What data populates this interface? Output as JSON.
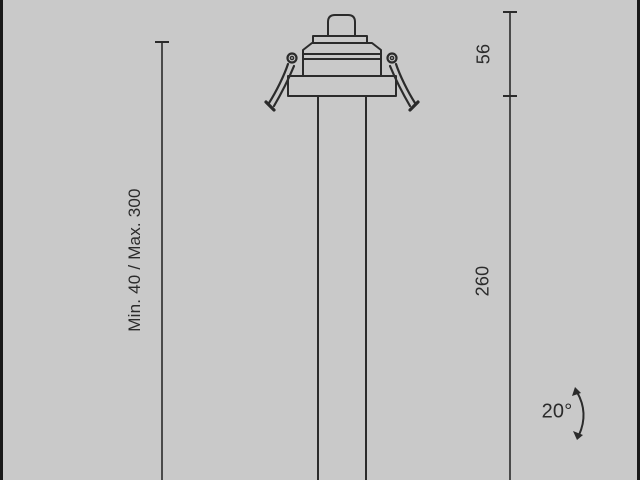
{
  "canvas": {
    "background_color": "#c9c9c9",
    "edge_bar_color": "#191919",
    "line_color": "#2b2b2b"
  },
  "drawing": {
    "kind": "technical dimension drawing",
    "subject": "recessed spotlight head with long stem, front elevation"
  },
  "labels": {
    "recess_depth": "Min. 40 / Max. 300",
    "head_height": "56",
    "stem_length": "260",
    "tilt_angle": "20°"
  }
}
